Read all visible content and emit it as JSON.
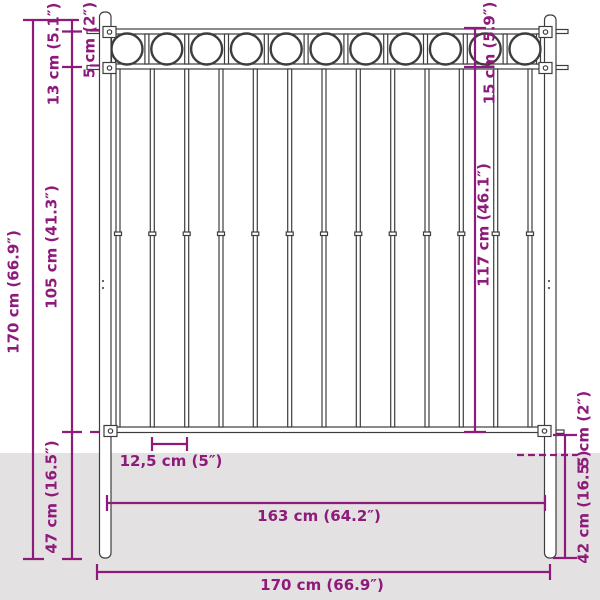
{
  "diagram": {
    "colors": {
      "accent": "#8E1B7B",
      "line": "#3D3D3D",
      "ground": "#E3E1E1",
      "fill": "#FFFFFF"
    },
    "fence": {
      "rings_count": 11,
      "bars_count": 13,
      "posts_count": 2
    },
    "dimensions": {
      "left_total_height": "170 cm (66.9″)",
      "left_ring_section": "13 cm (5.1″)",
      "left_top_offset": "5 cm (2″)",
      "left_bar_section": "105 cm (41.3″)",
      "left_underground": "47 cm (16.5″)",
      "right_ring_section": "15 cm (5.9″)",
      "right_bar_height": "117 cm (46.1″)",
      "right_rail_to_ground": "5 cm (2″)",
      "right_underground": "42 cm (16.5″)",
      "bar_spacing": "12,5 cm (5″)",
      "inner_width": "163 cm (64.2″)",
      "total_width": "170 cm (66.9″)"
    }
  }
}
